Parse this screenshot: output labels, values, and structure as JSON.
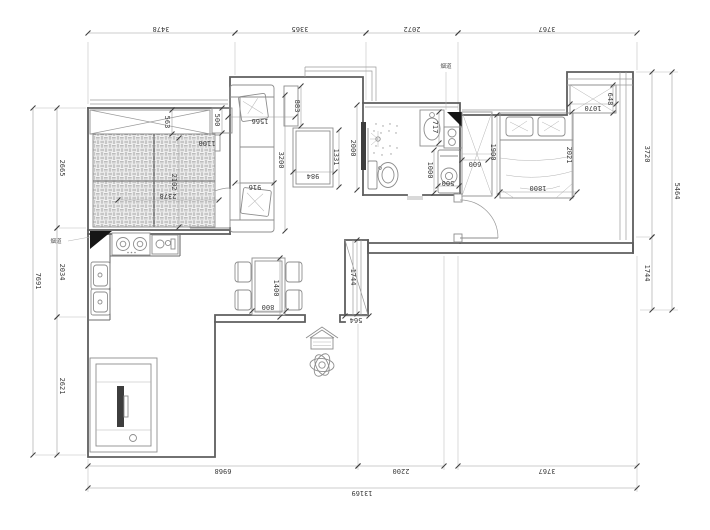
{
  "drawing": {
    "type": "apartment-floor-plan",
    "flue_label_left": "烟道",
    "flue_label_right": "烟道",
    "colors": {
      "background": "#ffffff",
      "wall": "#5e5e5e",
      "furniture": "#8d8d8d",
      "dimension_line": "#9c9c9c",
      "dimension_text": "#3a3a3a",
      "solid_fill": "#161616"
    },
    "dim_entries": [
      {
        "group": "top",
        "t": "3478",
        "x1": 88,
        "y1": 33,
        "x2": 235,
        "y2": 33,
        "lx": 161,
        "ly": 29,
        "rot": 180
      },
      {
        "group": "top",
        "t": "3365",
        "x1": 235,
        "y1": 33,
        "x2": 366,
        "y2": 33,
        "lx": 300,
        "ly": 29,
        "rot": 180
      },
      {
        "group": "top",
        "t": "2072",
        "x1": 366,
        "y1": 33,
        "x2": 458,
        "y2": 33,
        "lx": 412,
        "ly": 29,
        "rot": 180
      },
      {
        "group": "top",
        "t": "3767",
        "x1": 458,
        "y1": 33,
        "x2": 637,
        "y2": 33,
        "lx": 547,
        "ly": 29,
        "rot": 180
      },
      {
        "group": "bottom",
        "t": "6968",
        "x1": 88,
        "y1": 466,
        "x2": 358,
        "y2": 466,
        "lx": 223,
        "ly": 471,
        "rot": 180
      },
      {
        "group": "bottom",
        "t": "2200",
        "x1": 358,
        "y1": 466,
        "x2": 444,
        "y2": 466,
        "lx": 401,
        "ly": 471,
        "rot": 180
      },
      {
        "group": "bottom",
        "t": "3767",
        "x1": 458,
        "y1": 466,
        "x2": 637,
        "y2": 466,
        "lx": 547,
        "ly": 471,
        "rot": 180
      },
      {
        "group": "bottom-total",
        "t": "13169",
        "x1": 88,
        "y1": 488,
        "x2": 637,
        "y2": 488,
        "lx": 362,
        "ly": 493,
        "rot": 180
      },
      {
        "group": "left",
        "t": "2665",
        "x1": 57,
        "y1": 108,
        "x2": 57,
        "y2": 228,
        "lx": 62,
        "ly": 168,
        "rot": 90
      },
      {
        "group": "left",
        "t": "2034",
        "x1": 57,
        "y1": 228,
        "x2": 57,
        "y2": 317,
        "lx": 62,
        "ly": 272,
        "rot": 90
      },
      {
        "group": "left",
        "t": "2621",
        "x1": 57,
        "y1": 317,
        "x2": 57,
        "y2": 455,
        "lx": 62,
        "ly": 386,
        "rot": 90
      },
      {
        "group": "left-total",
        "t": "7691",
        "x1": 33,
        "y1": 108,
        "x2": 33,
        "y2": 455,
        "lx": 38,
        "ly": 281,
        "rot": 90
      },
      {
        "group": "right",
        "t": "3720",
        "x1": 652,
        "y1": 72,
        "x2": 652,
        "y2": 237,
        "lx": 647,
        "ly": 154,
        "rot": 90
      },
      {
        "group": "right",
        "t": "1744",
        "x1": 652,
        "y1": 237,
        "x2": 652,
        "y2": 310,
        "lx": 647,
        "ly": 273,
        "rot": 90
      },
      {
        "group": "right-total",
        "t": "5464",
        "x1": 672,
        "y1": 72,
        "x2": 672,
        "y2": 310,
        "lx": 677,
        "ly": 191,
        "rot": 90
      },
      {
        "group": "interior",
        "t": "563",
        "x1": 172,
        "y1": 110,
        "x2": 172,
        "y2": 134,
        "lx": 167,
        "ly": 122,
        "rot": 90
      },
      {
        "group": "interior",
        "t": "500",
        "x1": 222,
        "y1": 108,
        "x2": 222,
        "y2": 133,
        "lx": 217,
        "ly": 120,
        "rot": 90
      },
      {
        "group": "interior",
        "t": "1100",
        "noline": true,
        "lx": 207,
        "ly": 143,
        "rot": 180
      },
      {
        "group": "interior",
        "t": "2102",
        "x1": 179,
        "y1": 138,
        "x2": 179,
        "y2": 227,
        "lx": 174,
        "ly": 182,
        "rot": 90
      },
      {
        "group": "interior",
        "t": "2378",
        "x1": 118,
        "y1": 200,
        "x2": 219,
        "y2": 200,
        "lx": 168,
        "ly": 196,
        "rot": 180
      },
      {
        "group": "interior",
        "t": "1566",
        "x1": 228,
        "y1": 117,
        "x2": 295,
        "y2": 117,
        "lx": 260,
        "ly": 121,
        "rot": 180
      },
      {
        "group": "interior",
        "t": "883",
        "x1": 301,
        "y1": 86,
        "x2": 301,
        "y2": 126,
        "lx": 297,
        "ly": 106,
        "rot": 90
      },
      {
        "group": "interior",
        "t": "3200",
        "x1": 285,
        "y1": 95,
        "x2": 285,
        "y2": 231,
        "lx": 281,
        "ly": 160,
        "rot": 90
      },
      {
        "group": "interior",
        "t": "916",
        "x1": 235,
        "y1": 183,
        "x2": 274,
        "y2": 183,
        "lx": 255,
        "ly": 187,
        "rot": 180
      },
      {
        "group": "interior",
        "t": "984",
        "x1": 293,
        "y1": 172,
        "x2": 335,
        "y2": 172,
        "lx": 313,
        "ly": 176,
        "rot": 180
      },
      {
        "group": "interior",
        "t": "1331",
        "x1": 339,
        "y1": 130,
        "x2": 339,
        "y2": 187,
        "lx": 336,
        "ly": 157,
        "rot": 90
      },
      {
        "group": "interior",
        "t": "2000",
        "x1": 357,
        "y1": 105,
        "x2": 357,
        "y2": 190,
        "lx": 353,
        "ly": 148,
        "rot": 90
      },
      {
        "group": "interior",
        "t": "717",
        "x1": 439,
        "y1": 112,
        "x2": 439,
        "y2": 143,
        "lx": 435,
        "ly": 127,
        "rot": 90
      },
      {
        "group": "interior",
        "t": "1000",
        "x1": 434,
        "y1": 150,
        "x2": 434,
        "y2": 193,
        "lx": 430,
        "ly": 170,
        "rot": 90
      },
      {
        "group": "interior",
        "t": "500",
        "x1": 438,
        "y1": 186,
        "x2": 459,
        "y2": 186,
        "lx": 448,
        "ly": 183,
        "rot": 180
      },
      {
        "group": "interior",
        "t": "600",
        "x1": 462,
        "y1": 160,
        "x2": 488,
        "y2": 160,
        "lx": 475,
        "ly": 164,
        "rot": 180
      },
      {
        "group": "interior",
        "t": "1900",
        "x1": 497,
        "y1": 115,
        "x2": 497,
        "y2": 196,
        "lx": 493,
        "ly": 152,
        "rot": 90
      },
      {
        "group": "interior",
        "t": "2021",
        "x1": 572,
        "y1": 112,
        "x2": 572,
        "y2": 198,
        "lx": 569,
        "ly": 155,
        "rot": 90
      },
      {
        "group": "interior",
        "t": "1800",
        "x1": 500,
        "y1": 192,
        "x2": 577,
        "y2": 192,
        "lx": 538,
        "ly": 188,
        "rot": 180
      },
      {
        "group": "interior",
        "t": "1070",
        "x1": 570,
        "y1": 104,
        "x2": 616,
        "y2": 104,
        "lx": 593,
        "ly": 108,
        "rot": 180
      },
      {
        "group": "interior",
        "t": "648",
        "x1": 613,
        "y1": 85,
        "x2": 613,
        "y2": 113,
        "lx": 610,
        "ly": 99,
        "rot": 90
      },
      {
        "group": "interior",
        "t": "1744",
        "x1": 357,
        "y1": 240,
        "x2": 357,
        "y2": 314,
        "lx": 353,
        "ly": 277,
        "rot": 90
      },
      {
        "group": "interior",
        "t": "564",
        "x1": 345,
        "y1": 316,
        "x2": 369,
        "y2": 316,
        "lx": 356,
        "ly": 320,
        "rot": 180
      },
      {
        "group": "interior",
        "t": "1400",
        "x1": 280,
        "y1": 258,
        "x2": 280,
        "y2": 317,
        "lx": 276,
        "ly": 288,
        "rot": 90
      },
      {
        "group": "interior",
        "t": "800",
        "x1": 252,
        "y1": 311,
        "x2": 286,
        "y2": 311,
        "lx": 268,
        "ly": 307,
        "rot": 180
      }
    ]
  }
}
